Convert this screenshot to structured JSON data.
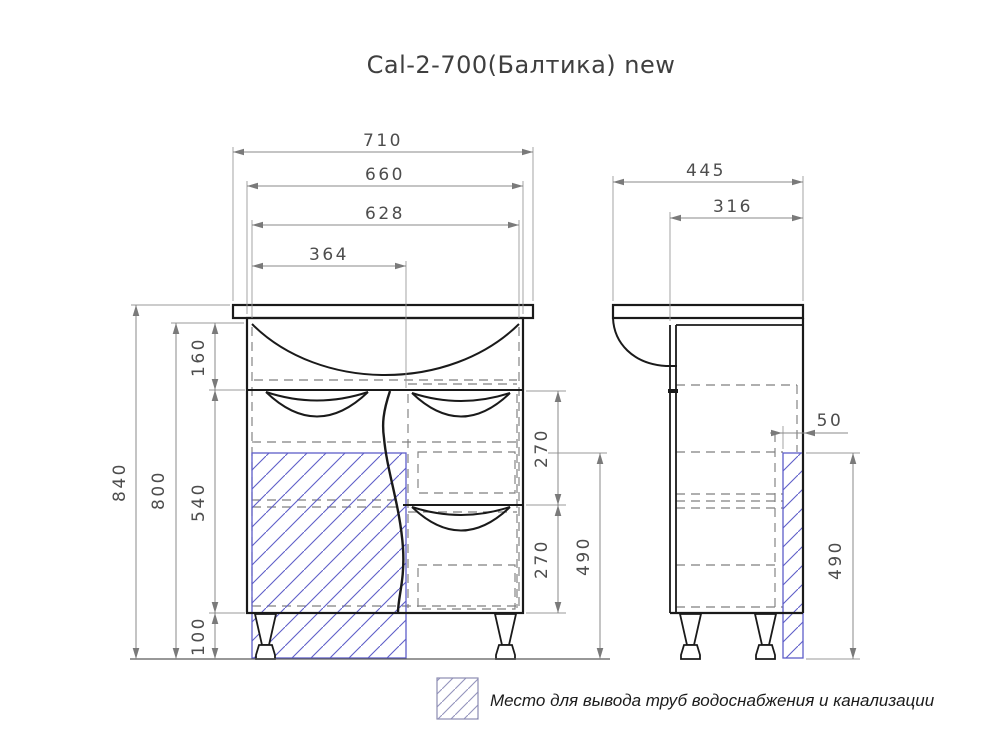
{
  "title": "Cal-2-700(Балтика) new",
  "front_view": {
    "dims": {
      "overall_width": "710",
      "cabinet_width": "660",
      "inner_width": "628",
      "pipe_zone_width": "364",
      "total_height": "840",
      "body_height": "800",
      "top_section_height": "160",
      "middle_section_height": "540",
      "legs_height": "100",
      "drawer_top_height": "270",
      "drawer_bottom_height": "270",
      "pipe_zone_height": "490"
    }
  },
  "side_view": {
    "dims": {
      "overall_depth": "445",
      "body_depth": "316",
      "pipe_zone_depth": "50",
      "pipe_zone_height": "490"
    }
  },
  "legend": {
    "label": "Место для вывода труб водоснабжения и канализации"
  },
  "colors": {
    "hatch_blue": "#5e5ec8",
    "line_dark": "#1a1a1a",
    "dim_gray": "#8a8a8a"
  }
}
